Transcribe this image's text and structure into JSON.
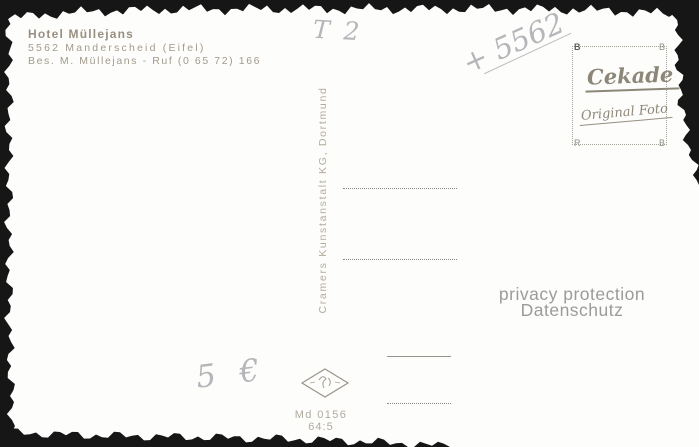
{
  "card": {
    "background": "#fdfdfb",
    "edge_color": "#161616"
  },
  "imprint": {
    "hotel": "Hotel Müllejans",
    "address": "5562 Manderscheid (Eifel)",
    "contact": "Bes. M. Müllejans - Ruf (0 65 72) 166",
    "color": "#a39a8c"
  },
  "handwriting": {
    "top_center": "T 2",
    "postal_code": "+ 5562",
    "price": "5 €",
    "color": "#b5b5ba"
  },
  "stamp_box": {
    "brand": "Cekade",
    "subtitle": "Original Foto",
    "corner_top_left": "B",
    "corner_top_right": "B",
    "corner_bottom_left": "R",
    "corner_bottom_right": "B",
    "color": "#8d8779"
  },
  "publisher": {
    "imprint": "Cramers Kunstanstalt KG, Dortmund",
    "color": "#b2aa9c"
  },
  "watermark": {
    "line1": "privacy protection",
    "line2": "Datenschutz",
    "color": "#9b9b9b"
  },
  "catalog": {
    "code": "Md 0156",
    "number": "64:5",
    "color": "#b0aba0"
  },
  "icons": {
    "diamond_logo": "cekade-diamond-outline"
  }
}
